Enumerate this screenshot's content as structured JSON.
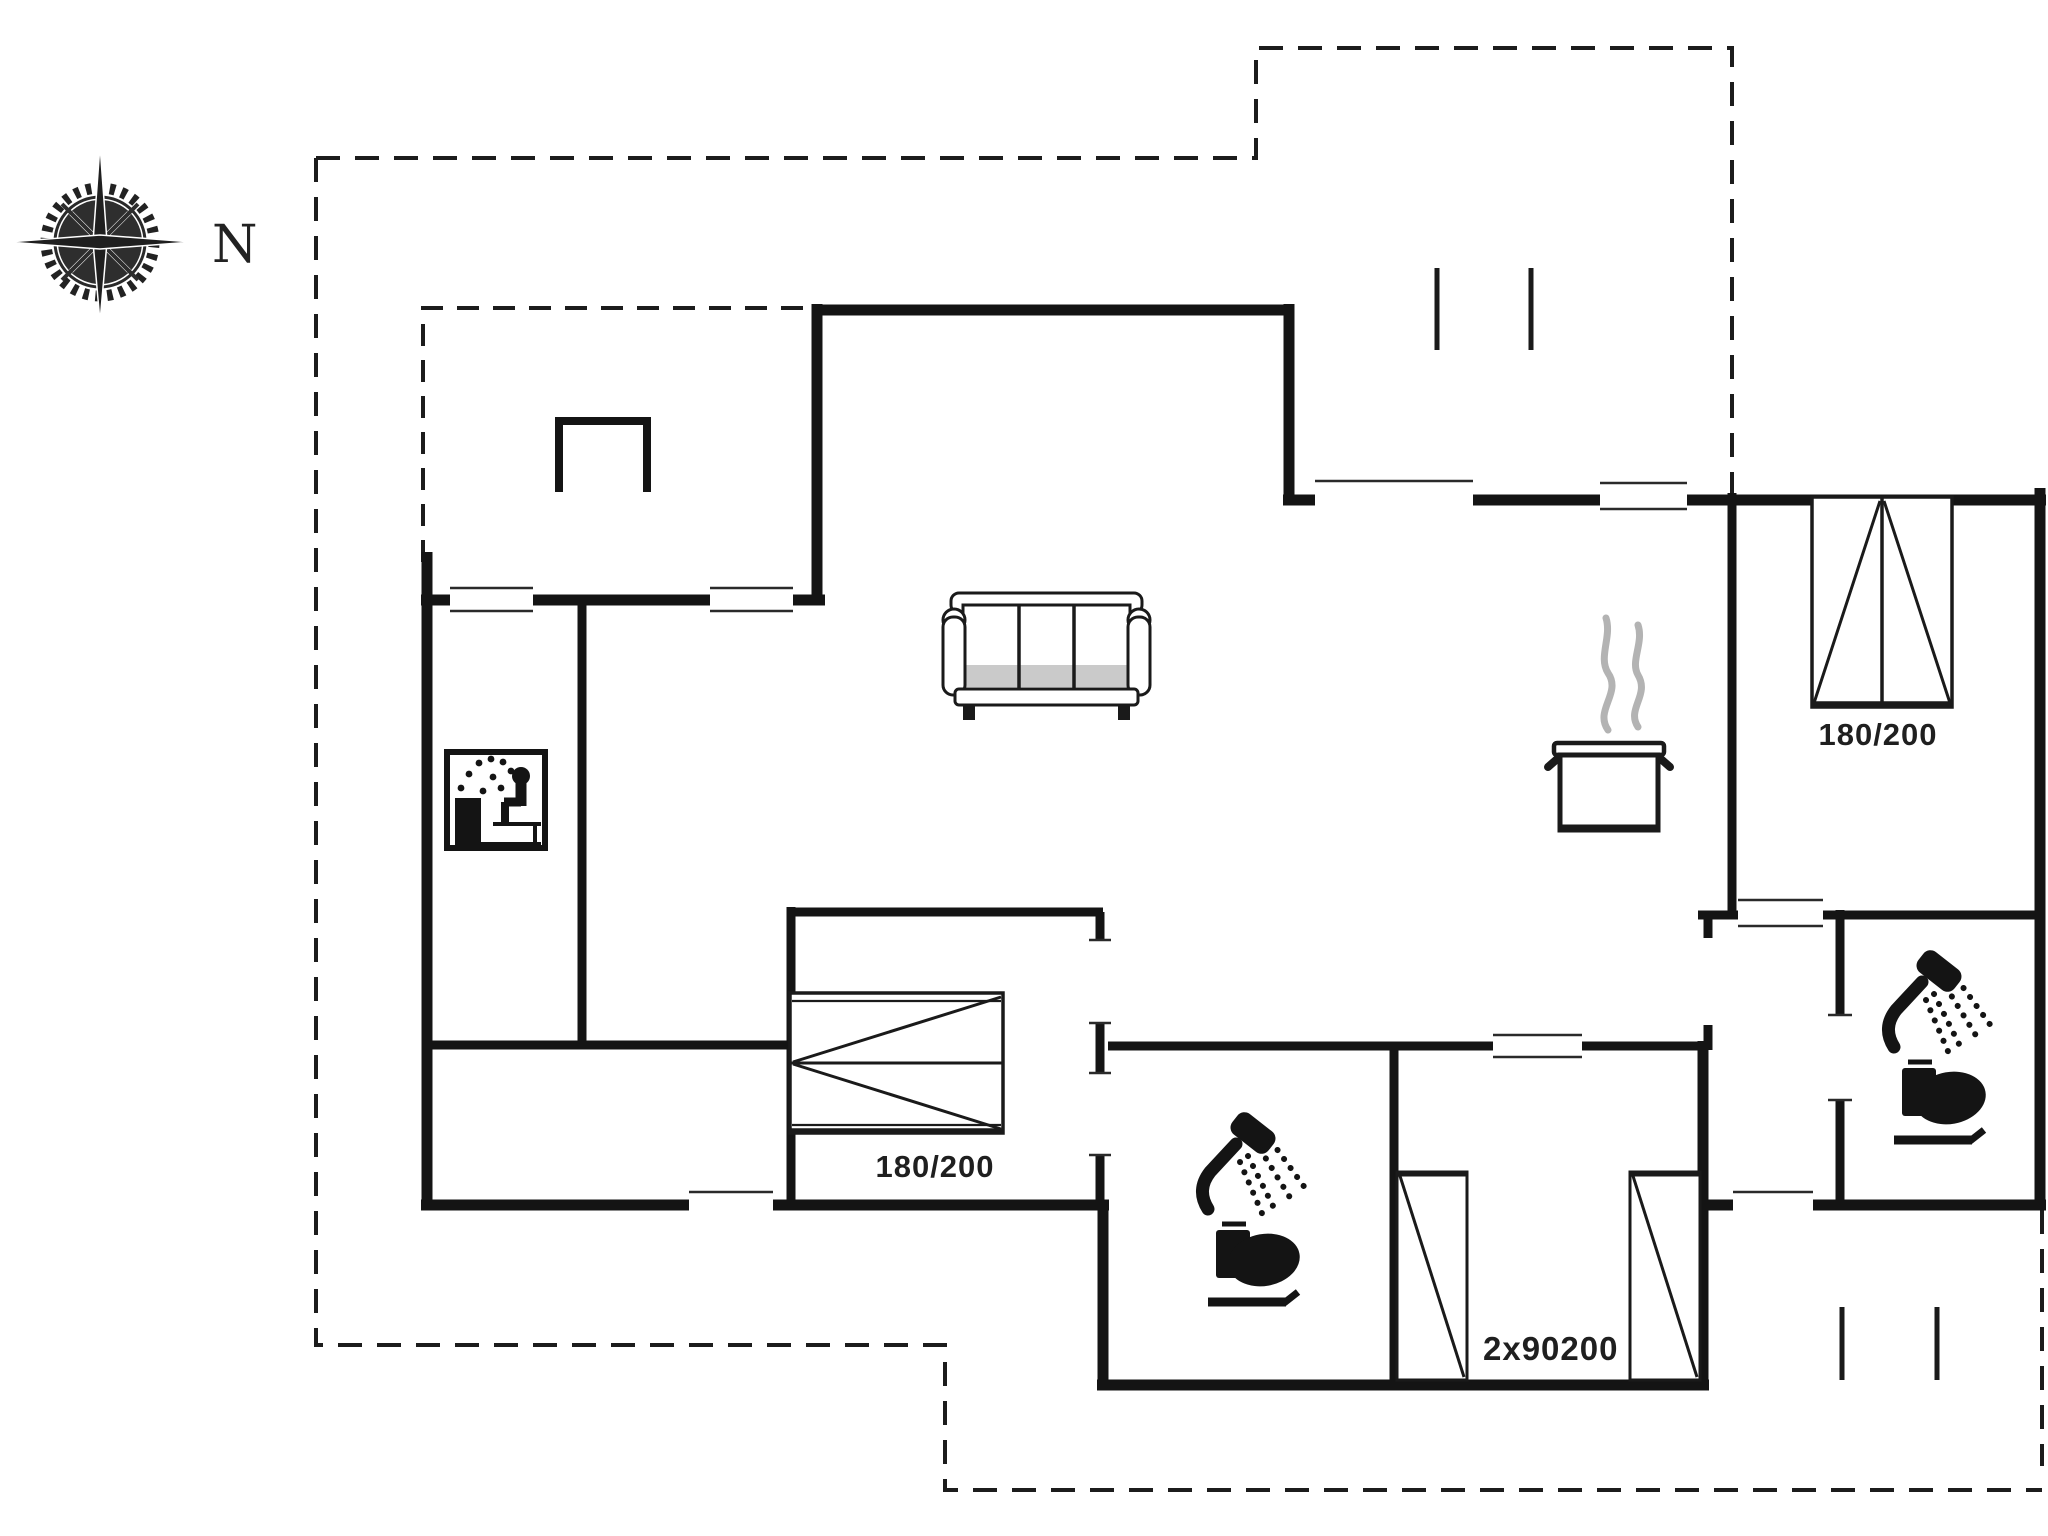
{
  "colors": {
    "background": "#ffffff",
    "wall": "#141414",
    "thin_line": "#2a2a2a",
    "dashed_boundary": "#1c1c1c",
    "steam": "#b3b3b3",
    "shade": "#9e9e9e",
    "text": "#1f1f1f"
  },
  "compass": {
    "north_label": "N"
  },
  "labels": {
    "bedroom_top_right_bed_size": "180/200",
    "bedroom_middle_bed_size": "180/200",
    "bunk_room_bed_size": "2x90200"
  },
  "icons": {
    "compass": "compass-rose-icon",
    "sauna": "sauna-pictogram-icon",
    "sofa": "three-seat-sofa-icon",
    "kitchen": "steaming-pot-icon",
    "bathroom": "toilet-with-shower-icon",
    "double_bed": "double-bed-icon",
    "bunk_beds": "single-bed-icon",
    "structure": "u-shaped-structure-icon"
  }
}
